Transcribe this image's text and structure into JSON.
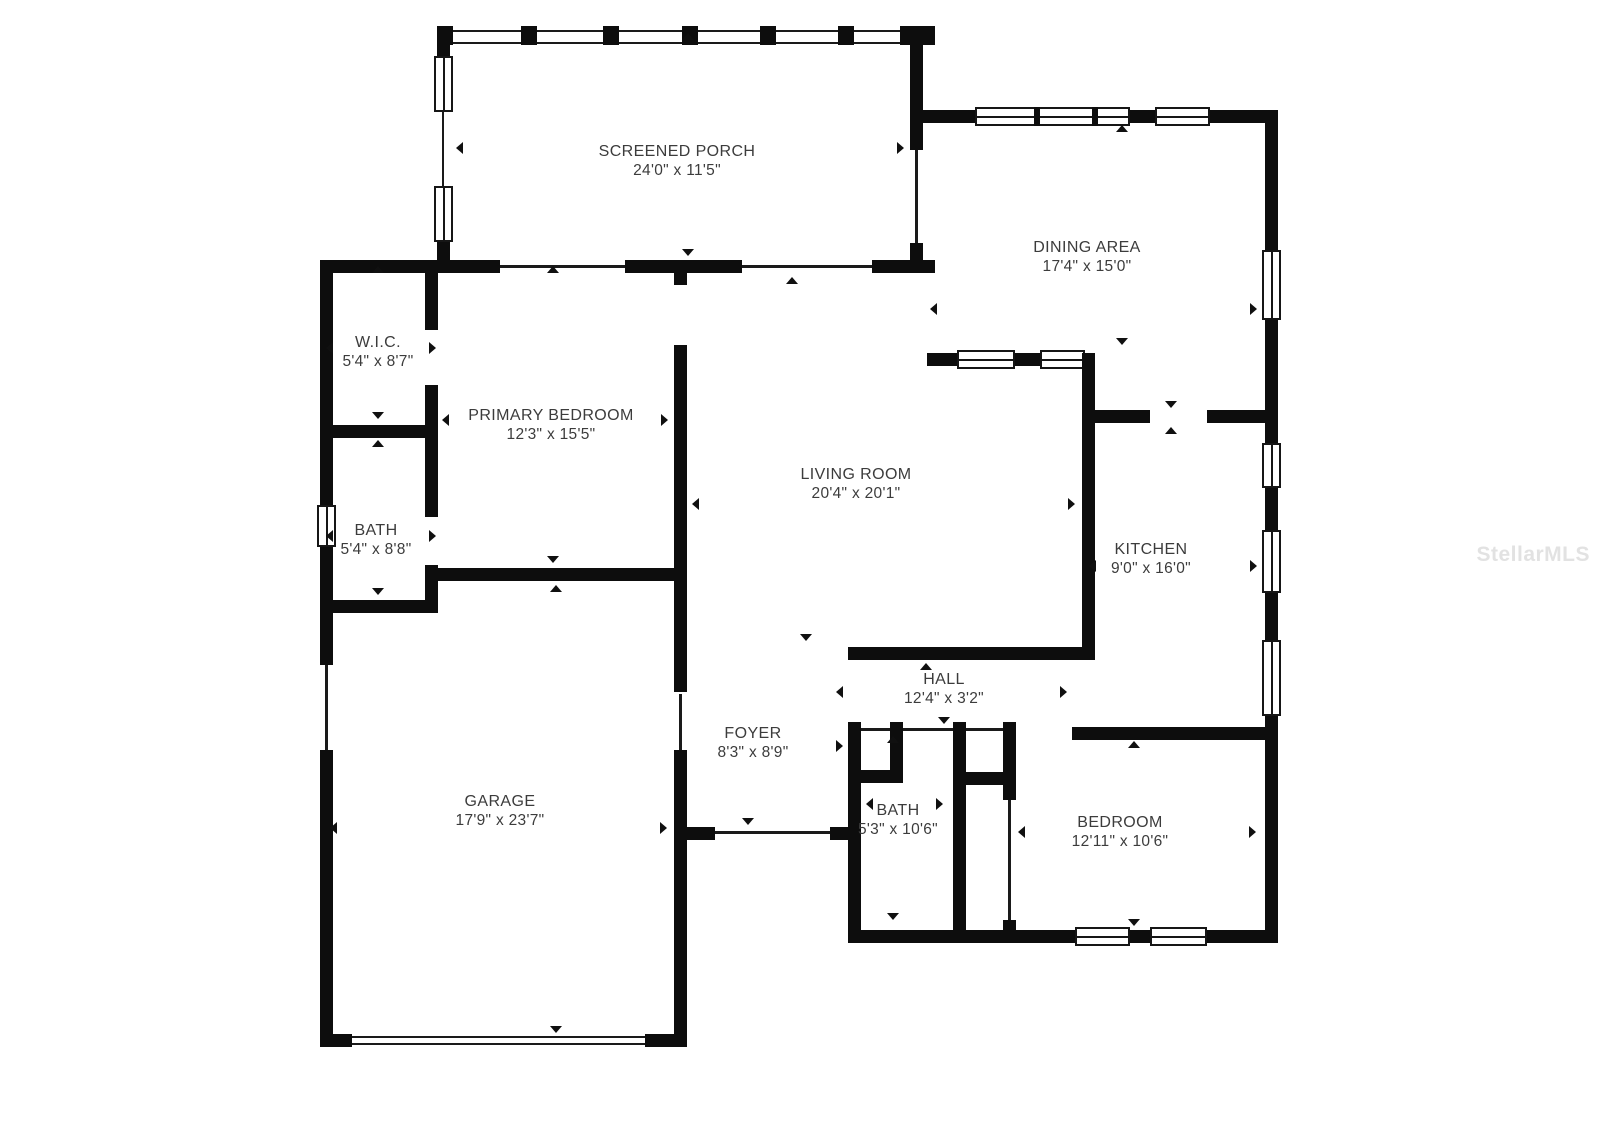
{
  "plan": {
    "type": "floor-plan",
    "rooms": [
      {
        "id": "screened-porch",
        "name": "SCREENED PORCH",
        "dims": "24'0\" x 11'5\""
      },
      {
        "id": "dining-area",
        "name": "DINING AREA",
        "dims": "17'4\" x 15'0\""
      },
      {
        "id": "wic",
        "name": "W.I.C.",
        "dims": "5'4\" x 8'7\""
      },
      {
        "id": "primary-bedroom",
        "name": "PRIMARY BEDROOM",
        "dims": "12'3\" x 15'5\""
      },
      {
        "id": "living-room",
        "name": "LIVING ROOM",
        "dims": "20'4\" x 20'1\""
      },
      {
        "id": "kitchen",
        "name": "KITCHEN",
        "dims": "9'0\" x 16'0\""
      },
      {
        "id": "bath-upper",
        "name": "BATH",
        "dims": "5'4\" x 8'8\""
      },
      {
        "id": "hall",
        "name": "HALL",
        "dims": "12'4\" x 3'2\""
      },
      {
        "id": "foyer",
        "name": "FOYER",
        "dims": "8'3\" x 8'9\""
      },
      {
        "id": "garage",
        "name": "GARAGE",
        "dims": "17'9\" x 23'7\""
      },
      {
        "id": "bath-lower",
        "name": "BATH",
        "dims": "5'3\" x 10'6\""
      },
      {
        "id": "bedroom",
        "name": "BEDROOM",
        "dims": "12'11\" x 10'6\""
      }
    ]
  },
  "watermark": {
    "text": "StellarMLS"
  },
  "colors": {
    "wall": "#0d0d0d",
    "label": "#3c3c3c",
    "watermark": "#e2e2e2",
    "background": "#ffffff"
  }
}
